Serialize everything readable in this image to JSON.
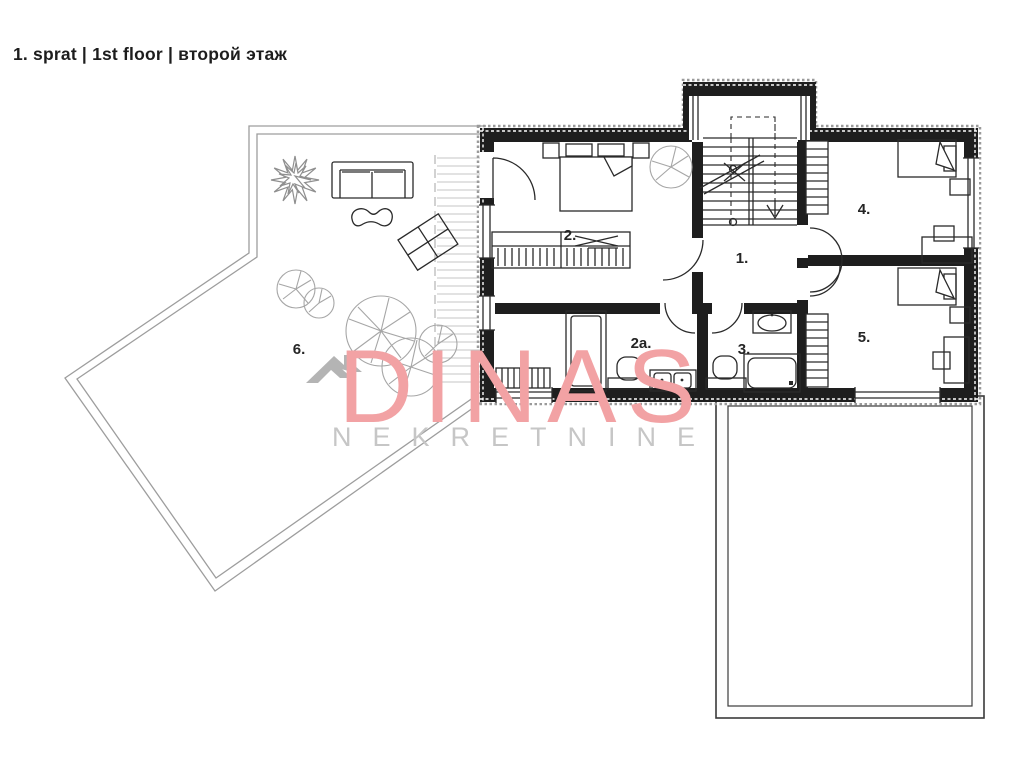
{
  "header": {
    "floor_label": "1. sprat | 1st floor | второй этаж"
  },
  "plan": {
    "type": "residential floor plan, first floor",
    "rooms": [
      {
        "number": "1.",
        "depicts": "hall with staircase"
      },
      {
        "number": "2.",
        "depicts": "bedroom with double bed and wardrobe"
      },
      {
        "number": "2a.",
        "depicts": "en-suite bathroom with shower, toilet, double sink"
      },
      {
        "number": "3.",
        "depicts": "bathroom with bathtub, toilet, sink"
      },
      {
        "number": "4.",
        "depicts": "bedroom with single bed and desk"
      },
      {
        "number": "5.",
        "depicts": "bedroom with single bed and desk"
      },
      {
        "number": "6.",
        "depicts": "large terrace with deck, sofa, lounger, trees"
      }
    ],
    "extras": [
      "lower roof / terrace outline at bottom right",
      "entry stair vestibule at top"
    ]
  },
  "watermark": {
    "brand": "DINAS",
    "tagline": "NEKRETNINE",
    "brand_color": "#f2a2a4",
    "tagline_color": "#c6c6c6",
    "icon_color": "#b4b4b4"
  },
  "colors": {
    "walls": "#1e1e1e",
    "plan_lines": "#2a2a2a",
    "terrace_lines": "#9d9d9d",
    "background": "#ffffff"
  }
}
